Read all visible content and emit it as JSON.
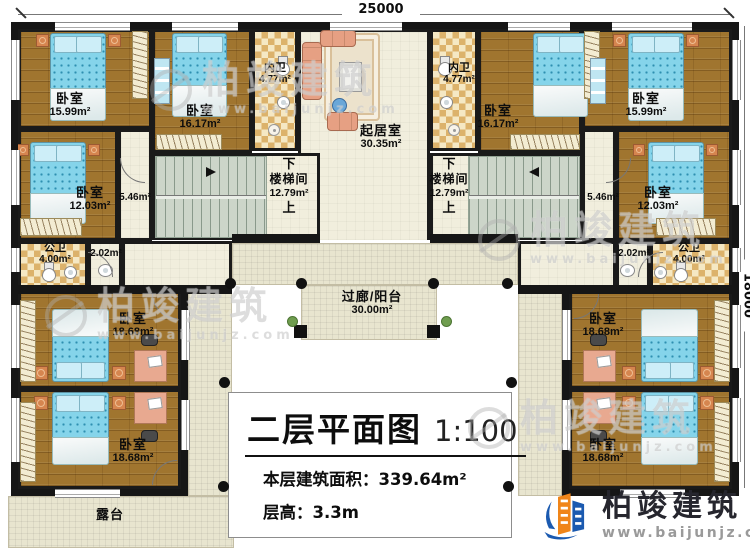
{
  "dimensions": {
    "top": "25000",
    "right": "18000"
  },
  "title_block": {
    "title": "二层平面图",
    "scale": "1:100",
    "area_label": "本层建筑面积：",
    "area_value": "339.64m²",
    "height_label": "层高：",
    "height_value": "3.3m"
  },
  "rooms": {
    "bedroom_tl": {
      "name": "卧室",
      "area": "15.99m²"
    },
    "bedroom_tl2": {
      "name": "卧室",
      "area": "16.17m²"
    },
    "innerbath_l": {
      "name": "内卫",
      "area": "4.77m²"
    },
    "living": {
      "name": "起居室",
      "area": "30.35m²"
    },
    "innerbath_r": {
      "name": "内卫",
      "area": "4.77m²"
    },
    "bedroom_tr2": {
      "name": "卧室",
      "area": "16.17m²"
    },
    "bedroom_tr": {
      "name": "卧室",
      "area": "15.99m²"
    },
    "bedroom_ml": {
      "name": "卧室",
      "area": "12.03m²"
    },
    "corridor_l": {
      "area": "5.46m²"
    },
    "stair_l": {
      "name": "楼梯间",
      "area": "12.79m²",
      "down": "下",
      "up": "上"
    },
    "stair_r": {
      "name": "楼梯间",
      "area": "12.79m²",
      "down": "下",
      "up": "上"
    },
    "corridor_r": {
      "area": "5.46m²"
    },
    "bedroom_mr": {
      "name": "卧室",
      "area": "12.03m²"
    },
    "pubbath_l": {
      "name": "公卫",
      "area": "4.00m²"
    },
    "lobby_l": {
      "area": "2.02m²"
    },
    "lobby_r": {
      "area": "2.02m²"
    },
    "pubbath_r": {
      "name": "公卫",
      "area": "4.00m²"
    },
    "bedroom_ll1": {
      "name": "卧室",
      "area": "18.68m²"
    },
    "bedroom_ll2": {
      "name": "卧室",
      "area": "18.68m²"
    },
    "bedroom_lr1": {
      "name": "卧室",
      "area": "18.68m²"
    },
    "bedroom_lr2": {
      "name": "卧室",
      "area": "18.68m²"
    },
    "balcony": {
      "name": "过廊/阳台",
      "area": "30.00m²"
    },
    "terrace": {
      "name": "露台"
    }
  },
  "branding": {
    "logo_text": "柏竣建筑",
    "logo_url": "www.baijunjz.com"
  },
  "watermark": {
    "text": "柏竣建筑",
    "url": "www.baijunjz.com"
  },
  "colors": {
    "wall": "#161616",
    "wood_floor": "#a0752f",
    "tile": "#dcb26b",
    "outdoor": "#e8e5cf",
    "bed": "#85d4ea",
    "logo_blue": "#1b5ab0",
    "logo_orange": "#f08519"
  }
}
